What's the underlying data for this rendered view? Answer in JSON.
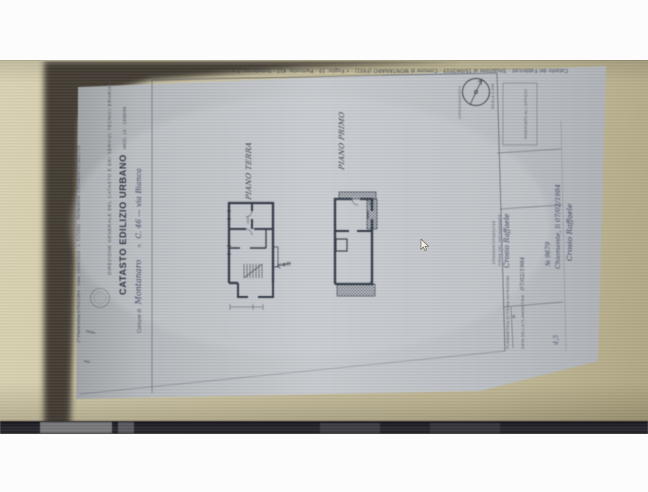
{
  "photo": {
    "colors": {
      "background_beige": "#cdc5a4",
      "paper": "#c2c6ca",
      "ink": "#39404d",
      "shadow": "#3a352e",
      "bottom_bar": "#25232a"
    },
    "document": {
      "margin_top_note": "1ª Planimetria 07/02/1984 - Data: 15/04/2019 - n. T272931 - Richiedente: CRSMGN73T16D171S",
      "margin_side_note": "Catasto dei Fabbricati - Situazione al 15/04/2019 - Comune di MONTANARO (F651) - < Foglio: 19 - Particella: 412 - Subalterno: 3 >",
      "header": {
        "agency_line": "DIREZIONE GENERALE DEL CATASTO E DEI SERVIZI TECNICI ERARIALI",
        "title": "CATASTO EDILIZIO URBANO",
        "mod_label": "MOD. 13 · 1938/48",
        "comune_label": "Comune di",
        "comune_value": "Montanaro",
        "address_label": "n.",
        "address_value": "C. 46 — via Bianca"
      },
      "plans": [
        {
          "label": "PIANO TERRA",
          "room_note": "cant."
        },
        {
          "label": "PIANO PRIMO"
        }
      ],
      "side_panel": {
        "orientation_label": "ORIENTAMENTO",
        "scale_label": "SCALA 1:200",
        "office_box_label": "RISERVATO ALL'UFFICIO",
        "print_lines": [
          "DATA DELLA PLANIMETRIA",
          "FIRMA DEL DICHIARANTE",
          "CRSMGN73T16D171S",
          "PLANIMETRIA DI PRIMA ISCRIZIONE"
        ],
        "handwriting": {
          "date": "07/02/1984",
          "name": "Crosio Raffaele",
          "place_date": "Chiomonte, lì 07/02/1984",
          "protocol": "№ 9679",
          "note": "4,5"
        },
        "asterisk": "✳"
      }
    }
  }
}
